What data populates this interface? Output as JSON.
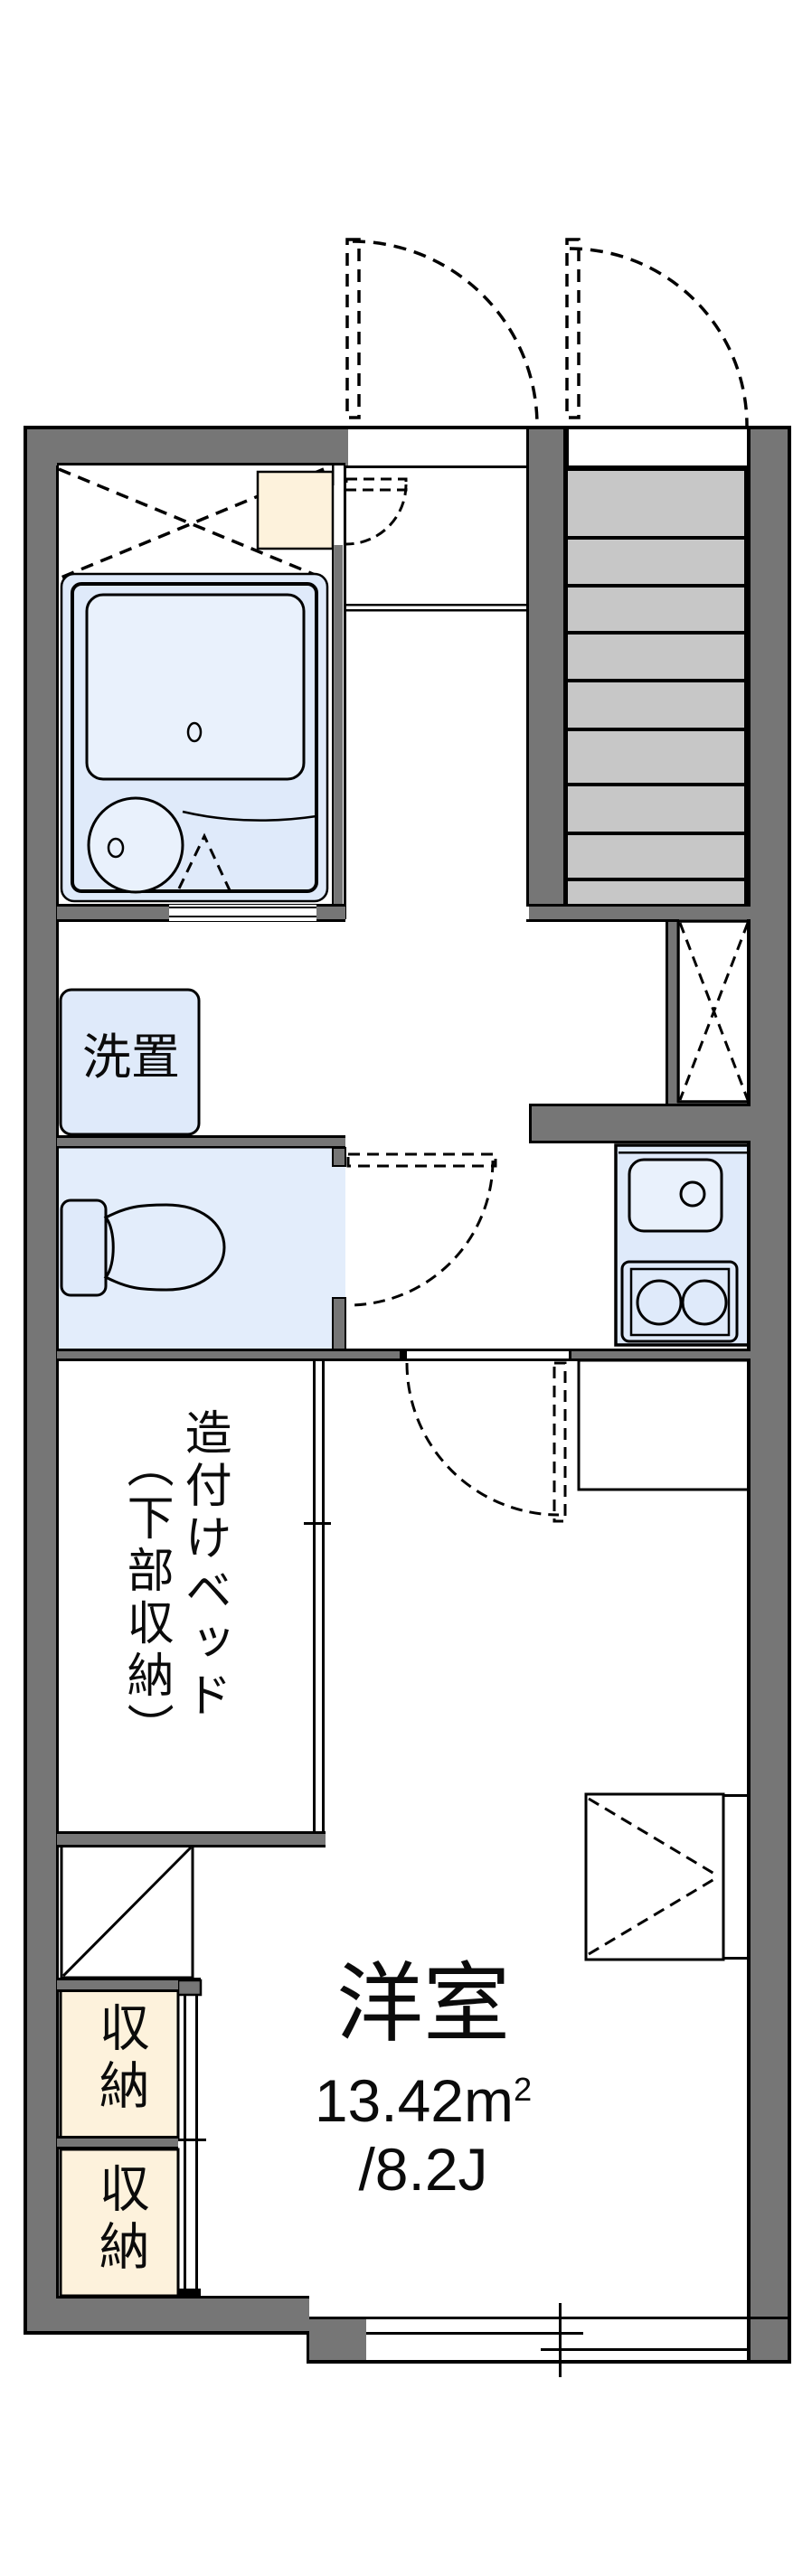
{
  "document": {
    "kind": "apartment-floor-plan"
  },
  "labels": {
    "washer": "洗置",
    "storage_upper": "収納",
    "storage_lower": "収納",
    "bed_name": "造付けベッド",
    "bed_note": "（下部収納）",
    "room_name": "洋室",
    "room_area_m": "13.42m",
    "room_area_sup": "2",
    "room_area_jo": "/8.2J"
  },
  "rooms": [
    {
      "name": "洋室",
      "area_m2": "13.42",
      "area_jo": "8.2"
    }
  ],
  "stairs": {
    "tread_lines": 8
  },
  "colors": {
    "wall": "#767676",
    "tread": "#c7c7c7",
    "fix": "#dfeafa",
    "fixlight": "#e9f1fc",
    "cream": "#fdf2dc",
    "line": "#000000",
    "bg": "#ffffff"
  }
}
